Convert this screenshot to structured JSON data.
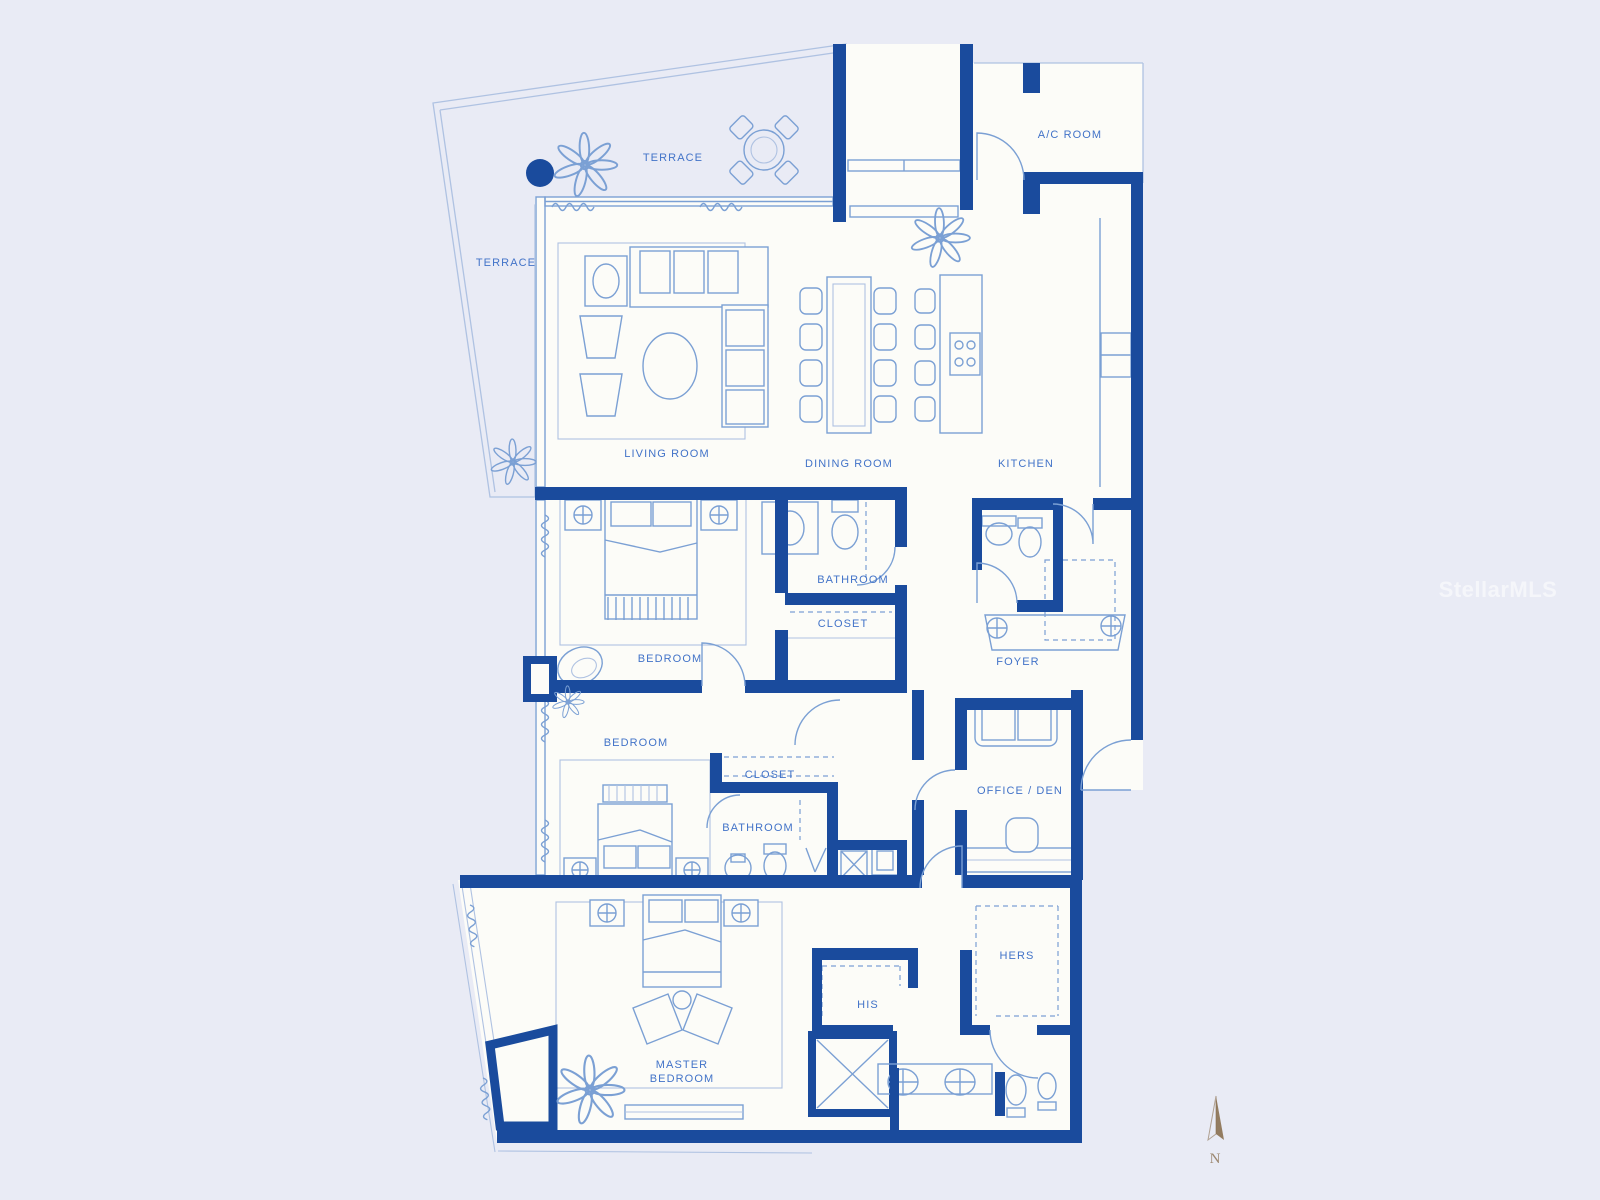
{
  "document_type": "residential-floor-plan-blueprint",
  "colors": {
    "background": "#E9EBF5",
    "paper": "#FCFCF8",
    "wall": "#1A4B9D",
    "line": "#7BA0D4",
    "line_light": "#AFC2E2",
    "label": "#4273C8",
    "watermark": "#FFFFFF",
    "north": "#8A7050"
  },
  "rooms": {
    "terrace_top": {
      "label": "TERRACE"
    },
    "terrace_left": {
      "label": "TERRACE"
    },
    "ac_room": {
      "label": "A/C ROOM"
    },
    "living_room": {
      "label": "LIVING ROOM"
    },
    "dining_room": {
      "label": "DINING ROOM"
    },
    "kitchen": {
      "label": "KITCHEN"
    },
    "bathroom_1": {
      "label": "BATHROOM"
    },
    "closet_1": {
      "label": "CLOSET"
    },
    "bedroom_1": {
      "label": "BEDROOM"
    },
    "foyer": {
      "label": "FOYER"
    },
    "bedroom_2": {
      "label": "BEDROOM"
    },
    "closet_2": {
      "label": "CLOSET"
    },
    "bathroom_2": {
      "label": "BATHROOM"
    },
    "office_den": {
      "label": "OFFICE / DEN"
    },
    "hers": {
      "label": "HERS"
    },
    "his": {
      "label": "HIS"
    },
    "master_bedroom": {
      "line1": "MASTER",
      "line2": "BEDROOM"
    }
  },
  "watermark": {
    "text": "StellarMLS"
  },
  "north_indicator": {
    "label": "N"
  }
}
